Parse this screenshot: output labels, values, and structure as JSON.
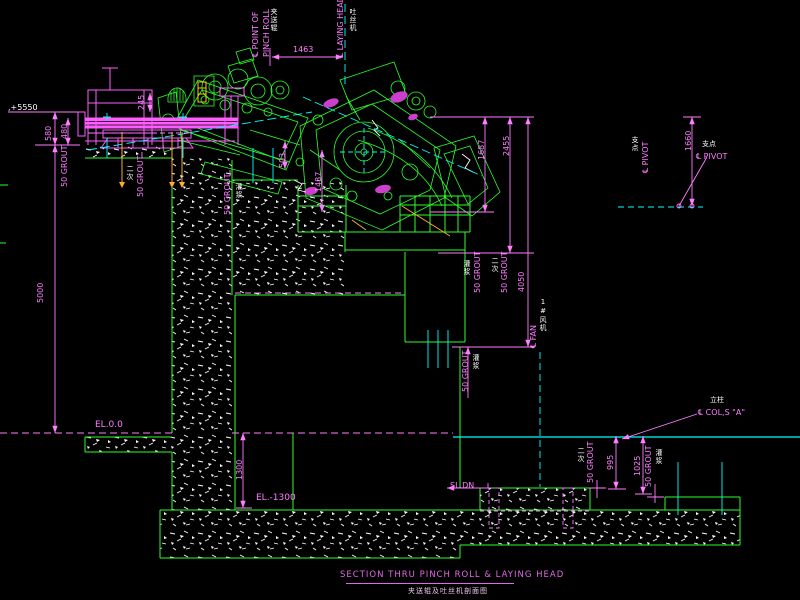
{
  "page": {
    "background": "#000000",
    "type": "cad-section-drawing"
  },
  "title": {
    "en": "SECTION THRU PINCH ROLL & LAYING HEAD",
    "zh": "夹送辊及吐丝机剖面图"
  },
  "labels": {
    "point_of": "℄ POINT OF",
    "pinch_roll": "PINCH ROLL",
    "pinch_roll_zh": "夹送辊",
    "laying_head": "℄ LAYING HEAD",
    "laying_head_zh": "吐丝机",
    "pivot": "℄ PIVOT",
    "pivot_zh": "支点",
    "fan": "℄ FAN",
    "fan_zh": "1#风机",
    "col_a": "℄ COL,S \"A\"",
    "col_a_zh": "立柱",
    "level_top": ",+5550",
    "el_zero": "EL.0.0",
    "el_minus_1300": "EL.-1300",
    "slope_down": "SL.DN",
    "grout": "50 GROUT",
    "grout_zh": "灌浆",
    "grout_secondary_zh": "二次"
  },
  "dimensions": {
    "d1463": "1463",
    "d580": "580",
    "d480": "480",
    "d5000": "5000",
    "d245": "245",
    "d503": "503",
    "d1487": "1487",
    "d1687": "1687",
    "d2455": "2455",
    "d4050": "4050",
    "d1660": "1660",
    "d1300": "1300",
    "d995": "995",
    "d1025": "1025"
  },
  "colors": {
    "background": "#000000",
    "machinery_green": "#2bff2b",
    "dimension_magenta": "#ff7dff",
    "centerline_cyan": "#00ffff",
    "anchor_orange": "#ffaa33",
    "roller_table_pink": "#ff5cff",
    "hatch_white": "#ffffff"
  }
}
